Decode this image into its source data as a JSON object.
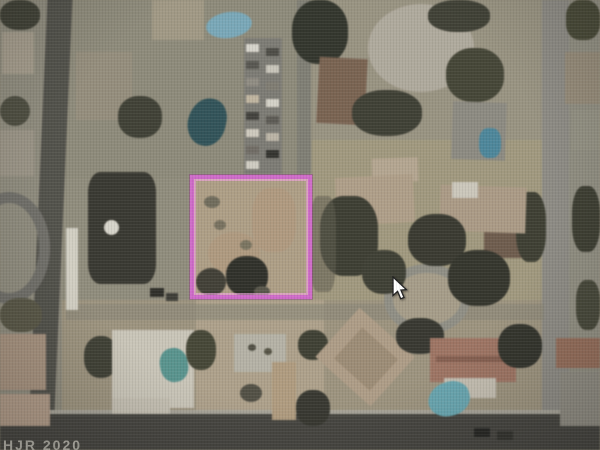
{
  "map": {
    "type": "satellite-aerial-view",
    "watermark": "HJR 2020",
    "highlight_color": "#cf6cc9",
    "parcel": {
      "x": 190,
      "y": 175,
      "w": 122,
      "h": 124
    },
    "cursor": {
      "x": 392,
      "y": 276
    },
    "features": [
      {
        "n": "ground-block",
        "x": 62,
        "y": 0,
        "w": 240,
        "h": 178,
        "c": "#8d8974"
      },
      {
        "n": "ground-block",
        "x": 312,
        "y": 0,
        "w": 230,
        "h": 180,
        "c": "#99927c"
      },
      {
        "n": "ground-block",
        "x": 62,
        "y": 178,
        "w": 128,
        "h": 148,
        "c": "#8f8b77"
      },
      {
        "n": "ground-block",
        "x": 312,
        "y": 140,
        "w": 230,
        "h": 170,
        "c": "#a29876"
      },
      {
        "n": "ground-block",
        "x": 62,
        "y": 300,
        "w": 480,
        "h": 130,
        "c": "#9e9278"
      },
      {
        "n": "ground-dirt-lot",
        "x": 196,
        "y": 300,
        "w": 128,
        "h": 128,
        "c": "#b0a084"
      },
      {
        "n": "ground-block",
        "x": 542,
        "y": 0,
        "w": 58,
        "h": 450,
        "c": "#908d7d"
      },
      {
        "n": "ground-block",
        "x": 0,
        "y": 0,
        "w": 62,
        "h": 450,
        "c": "#8e8a78"
      },
      {
        "n": "road-vertical-left",
        "x": 38,
        "y": -6,
        "w": 25,
        "h": 444,
        "c": "#4f4e46",
        "rot": 2.5
      },
      {
        "n": "road-vertical-right",
        "x": 542,
        "y": 0,
        "w": 27,
        "h": 450,
        "c": "#8c8a81"
      },
      {
        "n": "road-vertical-center",
        "x": 297,
        "y": 0,
        "w": 14,
        "h": 174,
        "c": "#7e7c70"
      },
      {
        "n": "road-horizontal-mid",
        "x": 66,
        "y": 304,
        "w": 478,
        "h": 16,
        "c": "#8a8672",
        "o": 0.65
      },
      {
        "n": "cul-de-sac",
        "x": 384,
        "y": 264,
        "w": 86,
        "h": 70,
        "c": "#a79c82",
        "bw": 9,
        "bc": "#8f8d81",
        "br": "50%"
      },
      {
        "n": "road-sidewalk",
        "x": 0,
        "y": 410,
        "w": 600,
        "h": 4,
        "c": "#a8a496"
      },
      {
        "n": "road-horizontal-bottom",
        "x": 0,
        "y": 414,
        "w": 600,
        "h": 36,
        "c": "#43423b"
      },
      {
        "n": "tree-cluster",
        "x": 0,
        "y": 0,
        "w": 40,
        "h": 30,
        "c": "#3d3e30",
        "br": "45%"
      },
      {
        "n": "house",
        "x": 2,
        "y": 32,
        "w": 32,
        "h": 42,
        "c": "#a49b86"
      },
      {
        "n": "tree-cluster",
        "x": 0,
        "y": 96,
        "w": 30,
        "h": 30,
        "c": "#4a4a3a",
        "br": "50%"
      },
      {
        "n": "house",
        "x": 0,
        "y": 130,
        "w": 34,
        "h": 46,
        "c": "#9b9381"
      },
      {
        "n": "loop-street",
        "x": -32,
        "y": 192,
        "w": 82,
        "h": 112,
        "c": "transparent",
        "bw": 11,
        "bc": "#6e6d65",
        "br": "50%"
      },
      {
        "n": "tree-cluster",
        "x": 0,
        "y": 298,
        "w": 42,
        "h": 34,
        "c": "#56543f",
        "br": "45%"
      },
      {
        "n": "house",
        "x": 0,
        "y": 334,
        "w": 46,
        "h": 56,
        "c": "#aa9078"
      },
      {
        "n": "house",
        "x": 0,
        "y": 394,
        "w": 50,
        "h": 32,
        "c": "#b49981"
      },
      {
        "n": "house",
        "x": 152,
        "y": 0,
        "w": 52,
        "h": 40,
        "c": "#a1977e"
      },
      {
        "n": "pool",
        "x": 206,
        "y": 12,
        "w": 46,
        "h": 26,
        "c": "#6fa9bd",
        "br": "50%",
        "rot": -8
      },
      {
        "n": "house",
        "x": 76,
        "y": 52,
        "w": 56,
        "h": 68,
        "c": "#958c76"
      },
      {
        "n": "tree-cluster",
        "x": 118,
        "y": 96,
        "w": 44,
        "h": 42,
        "c": "#3c3d2f",
        "br": "45%"
      },
      {
        "n": "pool",
        "x": 188,
        "y": 98,
        "w": 38,
        "h": 48,
        "c": "#275158",
        "br": "55% 45% 50% 50%",
        "rot": 12
      },
      {
        "n": "driveway",
        "x": 244,
        "y": 38,
        "w": 38,
        "h": 136,
        "c": "#7b7970"
      },
      {
        "n": "car",
        "x": 246,
        "y": 44,
        "w": 13,
        "h": 8,
        "c": "#d8d5c9"
      },
      {
        "n": "car",
        "x": 246,
        "y": 61,
        "w": 13,
        "h": 8,
        "c": "#55544c"
      },
      {
        "n": "car",
        "x": 246,
        "y": 78,
        "w": 13,
        "h": 8,
        "c": "#8f8b7e"
      },
      {
        "n": "car",
        "x": 246,
        "y": 95,
        "w": 13,
        "h": 8,
        "c": "#c2b49a"
      },
      {
        "n": "car",
        "x": 246,
        "y": 112,
        "w": 13,
        "h": 8,
        "c": "#3f3e38"
      },
      {
        "n": "car",
        "x": 246,
        "y": 129,
        "w": 13,
        "h": 8,
        "c": "#cfc9ba"
      },
      {
        "n": "car",
        "x": 246,
        "y": 146,
        "w": 13,
        "h": 8,
        "c": "#6e6a60"
      },
      {
        "n": "car",
        "x": 246,
        "y": 161,
        "w": 13,
        "h": 8,
        "c": "#d0cdc0"
      },
      {
        "n": "car",
        "x": 266,
        "y": 48,
        "w": 13,
        "h": 8,
        "c": "#4a4942"
      },
      {
        "n": "car",
        "x": 266,
        "y": 65,
        "w": 13,
        "h": 8,
        "c": "#c9c5b8"
      },
      {
        "n": "car",
        "x": 266,
        "y": 82,
        "w": 13,
        "h": 8,
        "c": "#7e7a6e"
      },
      {
        "n": "car",
        "x": 266,
        "y": 99,
        "w": 13,
        "h": 8,
        "c": "#d5d2c5"
      },
      {
        "n": "car",
        "x": 266,
        "y": 116,
        "w": 13,
        "h": 8,
        "c": "#5a5850"
      },
      {
        "n": "car",
        "x": 266,
        "y": 133,
        "w": 13,
        "h": 8,
        "c": "#bcb4a2"
      },
      {
        "n": "car",
        "x": 266,
        "y": 150,
        "w": 13,
        "h": 8,
        "c": "#2f2f29"
      },
      {
        "n": "tree-cluster",
        "x": 292,
        "y": 0,
        "w": 56,
        "h": 64,
        "c": "#2e3226",
        "br": "45%"
      },
      {
        "n": "house-dark",
        "x": 88,
        "y": 172,
        "w": 68,
        "h": 112,
        "c": "#35342b",
        "br": "18%"
      },
      {
        "n": "fountain",
        "x": 104,
        "y": 220,
        "w": 15,
        "h": 15,
        "c": "#d8d5c8",
        "br": "50%"
      },
      {
        "n": "walkway",
        "x": 66,
        "y": 228,
        "w": 12,
        "h": 82,
        "c": "#d4d0c1"
      },
      {
        "n": "car",
        "x": 150,
        "y": 288,
        "w": 14,
        "h": 9,
        "c": "#2a2a24"
      },
      {
        "n": "car",
        "x": 166,
        "y": 293,
        "w": 12,
        "h": 8,
        "c": "#3a3a32"
      },
      {
        "n": "house",
        "x": 318,
        "y": 58,
        "w": 48,
        "h": 66,
        "c": "#7c5f49",
        "rot": 3
      },
      {
        "n": "tree-cluster",
        "x": 352,
        "y": 90,
        "w": 70,
        "h": 46,
        "c": "#3b3c2e",
        "br": "45%"
      },
      {
        "n": "circular-driveway",
        "x": 368,
        "y": 4,
        "w": 106,
        "h": 88,
        "c": "#b0a998",
        "br": "50%"
      },
      {
        "n": "tree-cluster",
        "x": 428,
        "y": 0,
        "w": 62,
        "h": 32,
        "c": "#3c3d2f",
        "br": "45%"
      },
      {
        "n": "tree-cluster",
        "x": 446,
        "y": 48,
        "w": 58,
        "h": 54,
        "c": "#41422f",
        "br": "45%"
      },
      {
        "n": "tree-cluster",
        "x": 566,
        "y": 0,
        "w": 34,
        "h": 40,
        "c": "#45462f",
        "br": "40%"
      },
      {
        "n": "house",
        "x": 565,
        "y": 52,
        "w": 35,
        "h": 52,
        "c": "#968a73"
      },
      {
        "n": "house",
        "x": 572,
        "y": 110,
        "w": 28,
        "h": 40,
        "c": "#93907e"
      },
      {
        "n": "house",
        "x": 452,
        "y": 102,
        "w": 54,
        "h": 58,
        "c": "#8c897d",
        "rot": 2
      },
      {
        "n": "pool",
        "x": 479,
        "y": 128,
        "w": 22,
        "h": 30,
        "c": "#3f87a0",
        "br": "40%"
      },
      {
        "n": "house",
        "x": 484,
        "y": 196,
        "w": 52,
        "h": 62,
        "c": "#6f5845"
      },
      {
        "n": "tree-cluster",
        "x": 516,
        "y": 192,
        "w": 30,
        "h": 70,
        "c": "#3a3b2c",
        "br": "40%"
      },
      {
        "n": "tree-cluster",
        "x": 572,
        "y": 186,
        "w": 28,
        "h": 66,
        "c": "#3a3b2c",
        "br": "40%"
      },
      {
        "n": "tree-cluster",
        "x": 576,
        "y": 280,
        "w": 24,
        "h": 50,
        "c": "#444533",
        "br": "40%"
      },
      {
        "n": "house",
        "x": 372,
        "y": 158,
        "w": 46,
        "h": 24,
        "c": "#b7a58a",
        "rot": -2
      },
      {
        "n": "house",
        "x": 336,
        "y": 176,
        "w": 78,
        "h": 48,
        "c": "#b29d81",
        "rot": -3
      },
      {
        "n": "house",
        "x": 440,
        "y": 186,
        "w": 86,
        "h": 46,
        "c": "#ad997e",
        "rot": 2
      },
      {
        "n": "roof-white",
        "x": 452,
        "y": 182,
        "w": 26,
        "h": 16,
        "c": "#ccc7b8"
      },
      {
        "n": "tree-cluster",
        "x": 320,
        "y": 196,
        "w": 58,
        "h": 80,
        "c": "#393a2c",
        "br": "40%"
      },
      {
        "n": "tree-cluster",
        "x": 408,
        "y": 214,
        "w": 58,
        "h": 52,
        "c": "#35362a",
        "br": "45%"
      },
      {
        "n": "tree-cluster",
        "x": 448,
        "y": 250,
        "w": 62,
        "h": 56,
        "c": "#303126",
        "br": "45%"
      },
      {
        "n": "tree-cluster",
        "x": 362,
        "y": 250,
        "w": 44,
        "h": 44,
        "c": "#3b3c2e",
        "br": "45%"
      },
      {
        "n": "shadow",
        "x": 310,
        "y": 196,
        "w": 26,
        "h": 96,
        "c": "#5c5a49",
        "o": 0.55,
        "br": "30%"
      },
      {
        "n": "tree-cluster",
        "x": 84,
        "y": 336,
        "w": 34,
        "h": 42,
        "c": "#3c3d2f",
        "br": "45%"
      },
      {
        "n": "house-white-roof",
        "x": 112,
        "y": 330,
        "w": 82,
        "h": 78,
        "c": "#cbc5b5"
      },
      {
        "n": "house",
        "x": 112,
        "y": 398,
        "w": 58,
        "h": 16,
        "c": "#c5bfaf"
      },
      {
        "n": "pool",
        "x": 160,
        "y": 348,
        "w": 28,
        "h": 34,
        "c": "#4b958e",
        "br": "45%",
        "rot": -10
      },
      {
        "n": "tree-cluster",
        "x": 186,
        "y": 330,
        "w": 30,
        "h": 40,
        "c": "#42432f",
        "br": "45%"
      },
      {
        "n": "shed",
        "x": 234,
        "y": 334,
        "w": 52,
        "h": 38,
        "c": "#b5b2a2"
      },
      {
        "n": "shadow",
        "x": 248,
        "y": 344,
        "w": 8,
        "h": 7,
        "c": "#4f4c3e",
        "br": "50%"
      },
      {
        "n": "shadow",
        "x": 264,
        "y": 348,
        "w": 8,
        "h": 7,
        "c": "#54513f",
        "br": "50%"
      },
      {
        "n": "walkway",
        "x": 272,
        "y": 362,
        "w": 24,
        "h": 58,
        "c": "#b39a76"
      },
      {
        "n": "tree-cluster",
        "x": 240,
        "y": 384,
        "w": 22,
        "h": 18,
        "c": "#4f4c3e",
        "br": "50%"
      },
      {
        "n": "tree-cluster",
        "x": 298,
        "y": 330,
        "w": 30,
        "h": 30,
        "c": "#3b3c2c",
        "br": "45%"
      },
      {
        "n": "tree-cluster",
        "x": 296,
        "y": 390,
        "w": 34,
        "h": 36,
        "c": "#33342a",
        "br": "45%"
      },
      {
        "n": "house",
        "x": 328,
        "y": 324,
        "w": 74,
        "h": 66,
        "c": "#b19b7f",
        "rot": 42
      },
      {
        "n": "roof",
        "x": 342,
        "y": 338,
        "w": 48,
        "h": 42,
        "c": "#9f8a6e",
        "rot": 42
      },
      {
        "n": "tree-cluster",
        "x": 396,
        "y": 318,
        "w": 48,
        "h": 36,
        "c": "#33342a",
        "br": "45%"
      },
      {
        "n": "house-red-roof",
        "x": 430,
        "y": 338,
        "w": 86,
        "h": 44,
        "c": "#a4705b"
      },
      {
        "n": "roof-ridge",
        "x": 436,
        "y": 356,
        "w": 76,
        "h": 6,
        "c": "#8a5a47"
      },
      {
        "n": "patio",
        "x": 444,
        "y": 378,
        "w": 52,
        "h": 20,
        "c": "#c5beae"
      },
      {
        "n": "pool",
        "x": 428,
        "y": 382,
        "w": 42,
        "h": 34,
        "c": "#5ba8b4",
        "br": "55% 45% 50% 50%",
        "rot": -15
      },
      {
        "n": "tree-cluster",
        "x": 498,
        "y": 324,
        "w": 44,
        "h": 44,
        "c": "#2f3026",
        "br": "45%"
      },
      {
        "n": "house-red-roof",
        "x": 556,
        "y": 338,
        "w": 44,
        "h": 30,
        "c": "#9a6a52"
      },
      {
        "n": "house",
        "x": 560,
        "y": 372,
        "w": 40,
        "h": 54,
        "c": "#8e8a7d"
      },
      {
        "n": "car",
        "x": 474,
        "y": 428,
        "w": 16,
        "h": 9,
        "c": "#23231f"
      },
      {
        "n": "car",
        "x": 497,
        "y": 431,
        "w": 16,
        "h": 9,
        "c": "#30302a"
      },
      {
        "n": "parcel-ground",
        "x": 191,
        "y": 176,
        "w": 120,
        "h": 122,
        "c": "#b19d7e",
        "tex": "speckle"
      },
      {
        "n": "ground-tint",
        "x": 252,
        "y": 188,
        "w": 44,
        "h": 64,
        "c": "#c08a5e",
        "o": 0.22,
        "br": "40%"
      },
      {
        "n": "ground-tint",
        "x": 208,
        "y": 232,
        "w": 52,
        "h": 42,
        "c": "#bd8757",
        "o": 0.18,
        "br": "50%"
      },
      {
        "n": "shadow",
        "x": 204,
        "y": 196,
        "w": 16,
        "h": 12,
        "c": "#6f6a55",
        "br": "50%"
      },
      {
        "n": "shadow",
        "x": 214,
        "y": 220,
        "w": 12,
        "h": 10,
        "c": "#776f58",
        "br": "50%"
      },
      {
        "n": "shadow",
        "x": 240,
        "y": 240,
        "w": 12,
        "h": 10,
        "c": "#7a7258",
        "br": "50%"
      },
      {
        "n": "tree-cluster",
        "x": 196,
        "y": 268,
        "w": 30,
        "h": 28,
        "c": "#3e3c30",
        "br": "50%"
      },
      {
        "n": "tree-large",
        "x": 226,
        "y": 256,
        "w": 42,
        "h": 40,
        "c": "#2b2c23",
        "br": "45%"
      },
      {
        "n": "shadow",
        "x": 254,
        "y": 286,
        "w": 16,
        "h": 11,
        "c": "#565445",
        "br": "50%"
      }
    ]
  }
}
